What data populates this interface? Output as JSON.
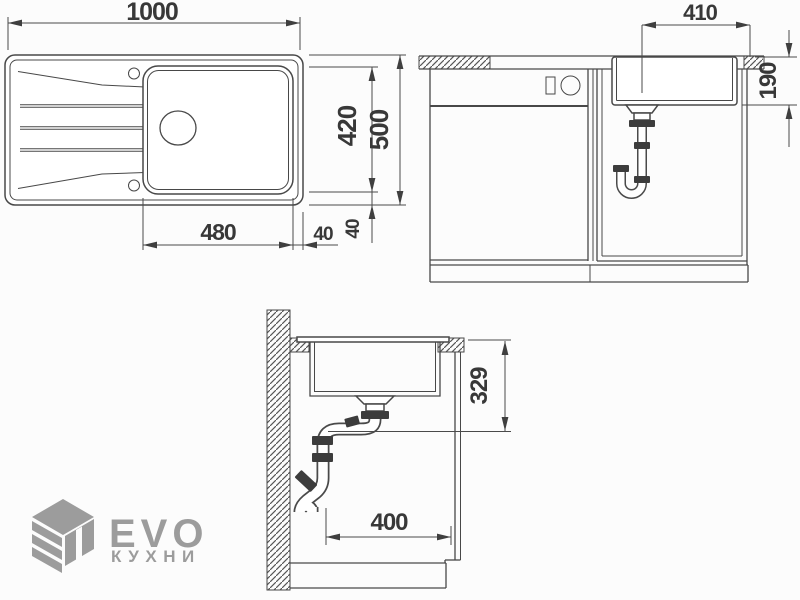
{
  "meta": {
    "background_color": "#fcfcfc",
    "line_color": "#484848",
    "dimension_text_color": "#383838",
    "logo_color": "#9c9c9c"
  },
  "views": {
    "plan": {
      "dims": {
        "width_total": "1000",
        "depth_total": "500",
        "bowl_depth": "420",
        "bowl_width": "480",
        "offset_right": "40",
        "offset_bottom": "40"
      }
    },
    "front": {
      "dims": {
        "bowl_width": "410",
        "bowl_height": "190"
      }
    },
    "section": {
      "dims": {
        "drain_height": "329",
        "cabinet_depth": "400"
      }
    }
  },
  "logo": {
    "brand": "EVO",
    "subtitle": "КУХНИ",
    "icon": "cube-logo-icon"
  }
}
